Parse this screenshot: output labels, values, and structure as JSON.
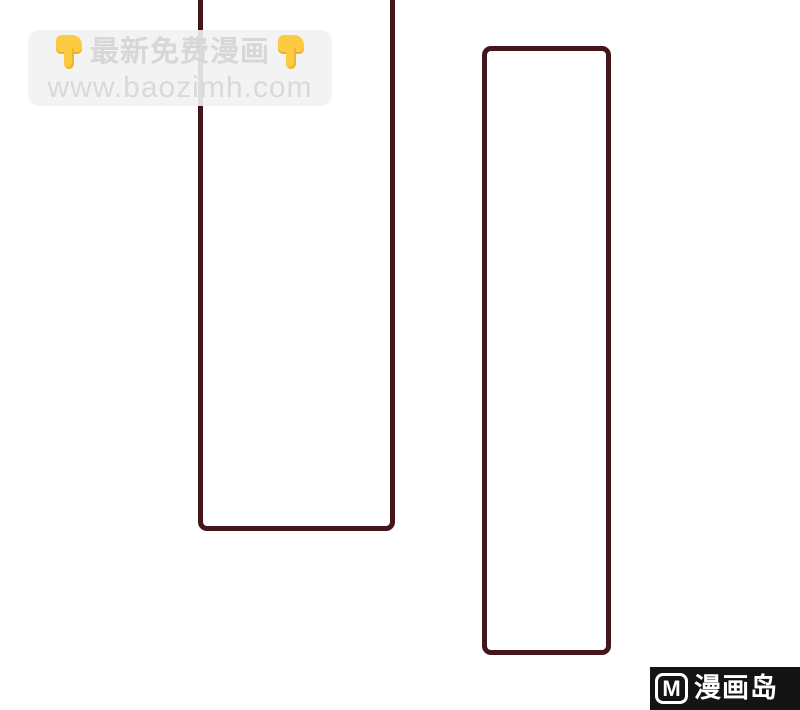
{
  "page": {
    "background_color": "#ffffff",
    "panel_border_color": "#44151a",
    "panel_count": 2
  },
  "watermark_top": {
    "line1_text": "最新免费漫画",
    "line2_text": "www.baozimh.com",
    "emoji_left": "👇",
    "emoji_right": "👇",
    "emoji_name": "point-down-hand",
    "emoji_color": "#fccb42",
    "box_color": "rgba(242,242,242,0.9)",
    "text_color": "#d7d7d7"
  },
  "watermark_bottom": {
    "logo_letter": "M",
    "site_name": "漫画岛",
    "bar_color": "#141414",
    "text_color": "#ffffff"
  }
}
